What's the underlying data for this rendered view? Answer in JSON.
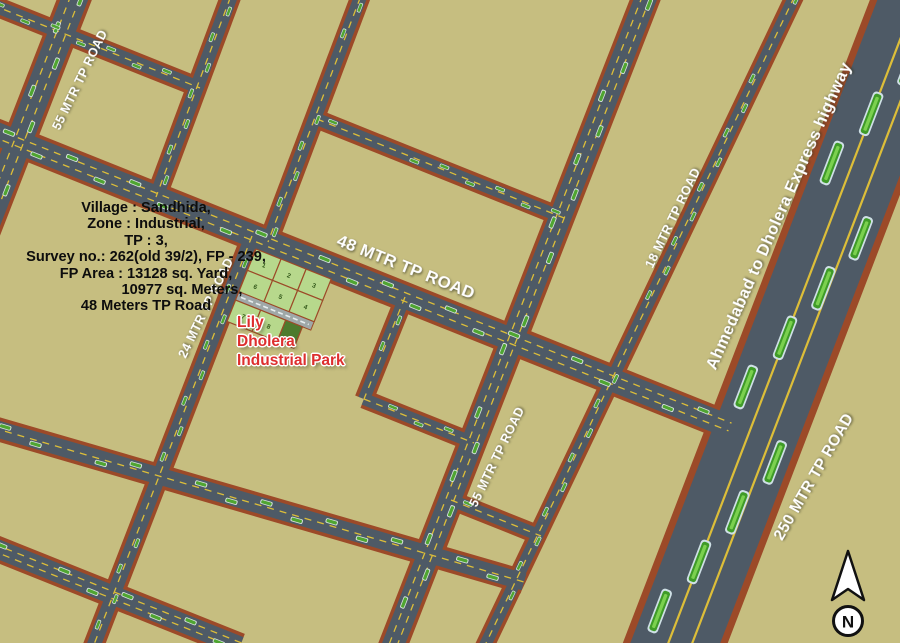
{
  "map": {
    "colors": {
      "background": "#c6be80",
      "road": "#4e5a66",
      "road_edge": "#9c4a28",
      "lane_line": "#ddbe39",
      "vehicle_green": "#4fa531",
      "plot_fill": "#b7d88c",
      "plot_dark_fill": "#4d7a2d",
      "site_label_red": "#dd2e2e"
    },
    "labels": {
      "road_55_topleft": "55 MTR TP ROAD",
      "road_24": "24 MTR TP ROAD",
      "road_48": "48 MTR TP ROAD",
      "road_55_center": "55 MTR TP ROAD",
      "road_18": "18 MTR TP ROAD",
      "highway": "Ahmedabad to Dholera Express highway",
      "road_250": "250 MTR TP ROAD"
    },
    "site_label": {
      "lines": [
        "Lily",
        "Dholera",
        "Industrial Park"
      ]
    },
    "info_block": {
      "lines": [
        "Village : Sandhida,",
        "Zone : Industrial,",
        "TP : 3,",
        "Survey no.: 262(old 39/2), FP - 239,",
        "FP Area : 13128 sq. Yard,",
        "10977 sq. Meters,",
        "48 Meters TP Road"
      ]
    },
    "plots": {
      "numbers_row1": [
        "1",
        "2",
        "3"
      ],
      "numbers_row2": [
        "6",
        "5",
        "4"
      ],
      "numbers_row3": [
        "7",
        "8"
      ]
    },
    "compass": {
      "letter": "N"
    }
  }
}
